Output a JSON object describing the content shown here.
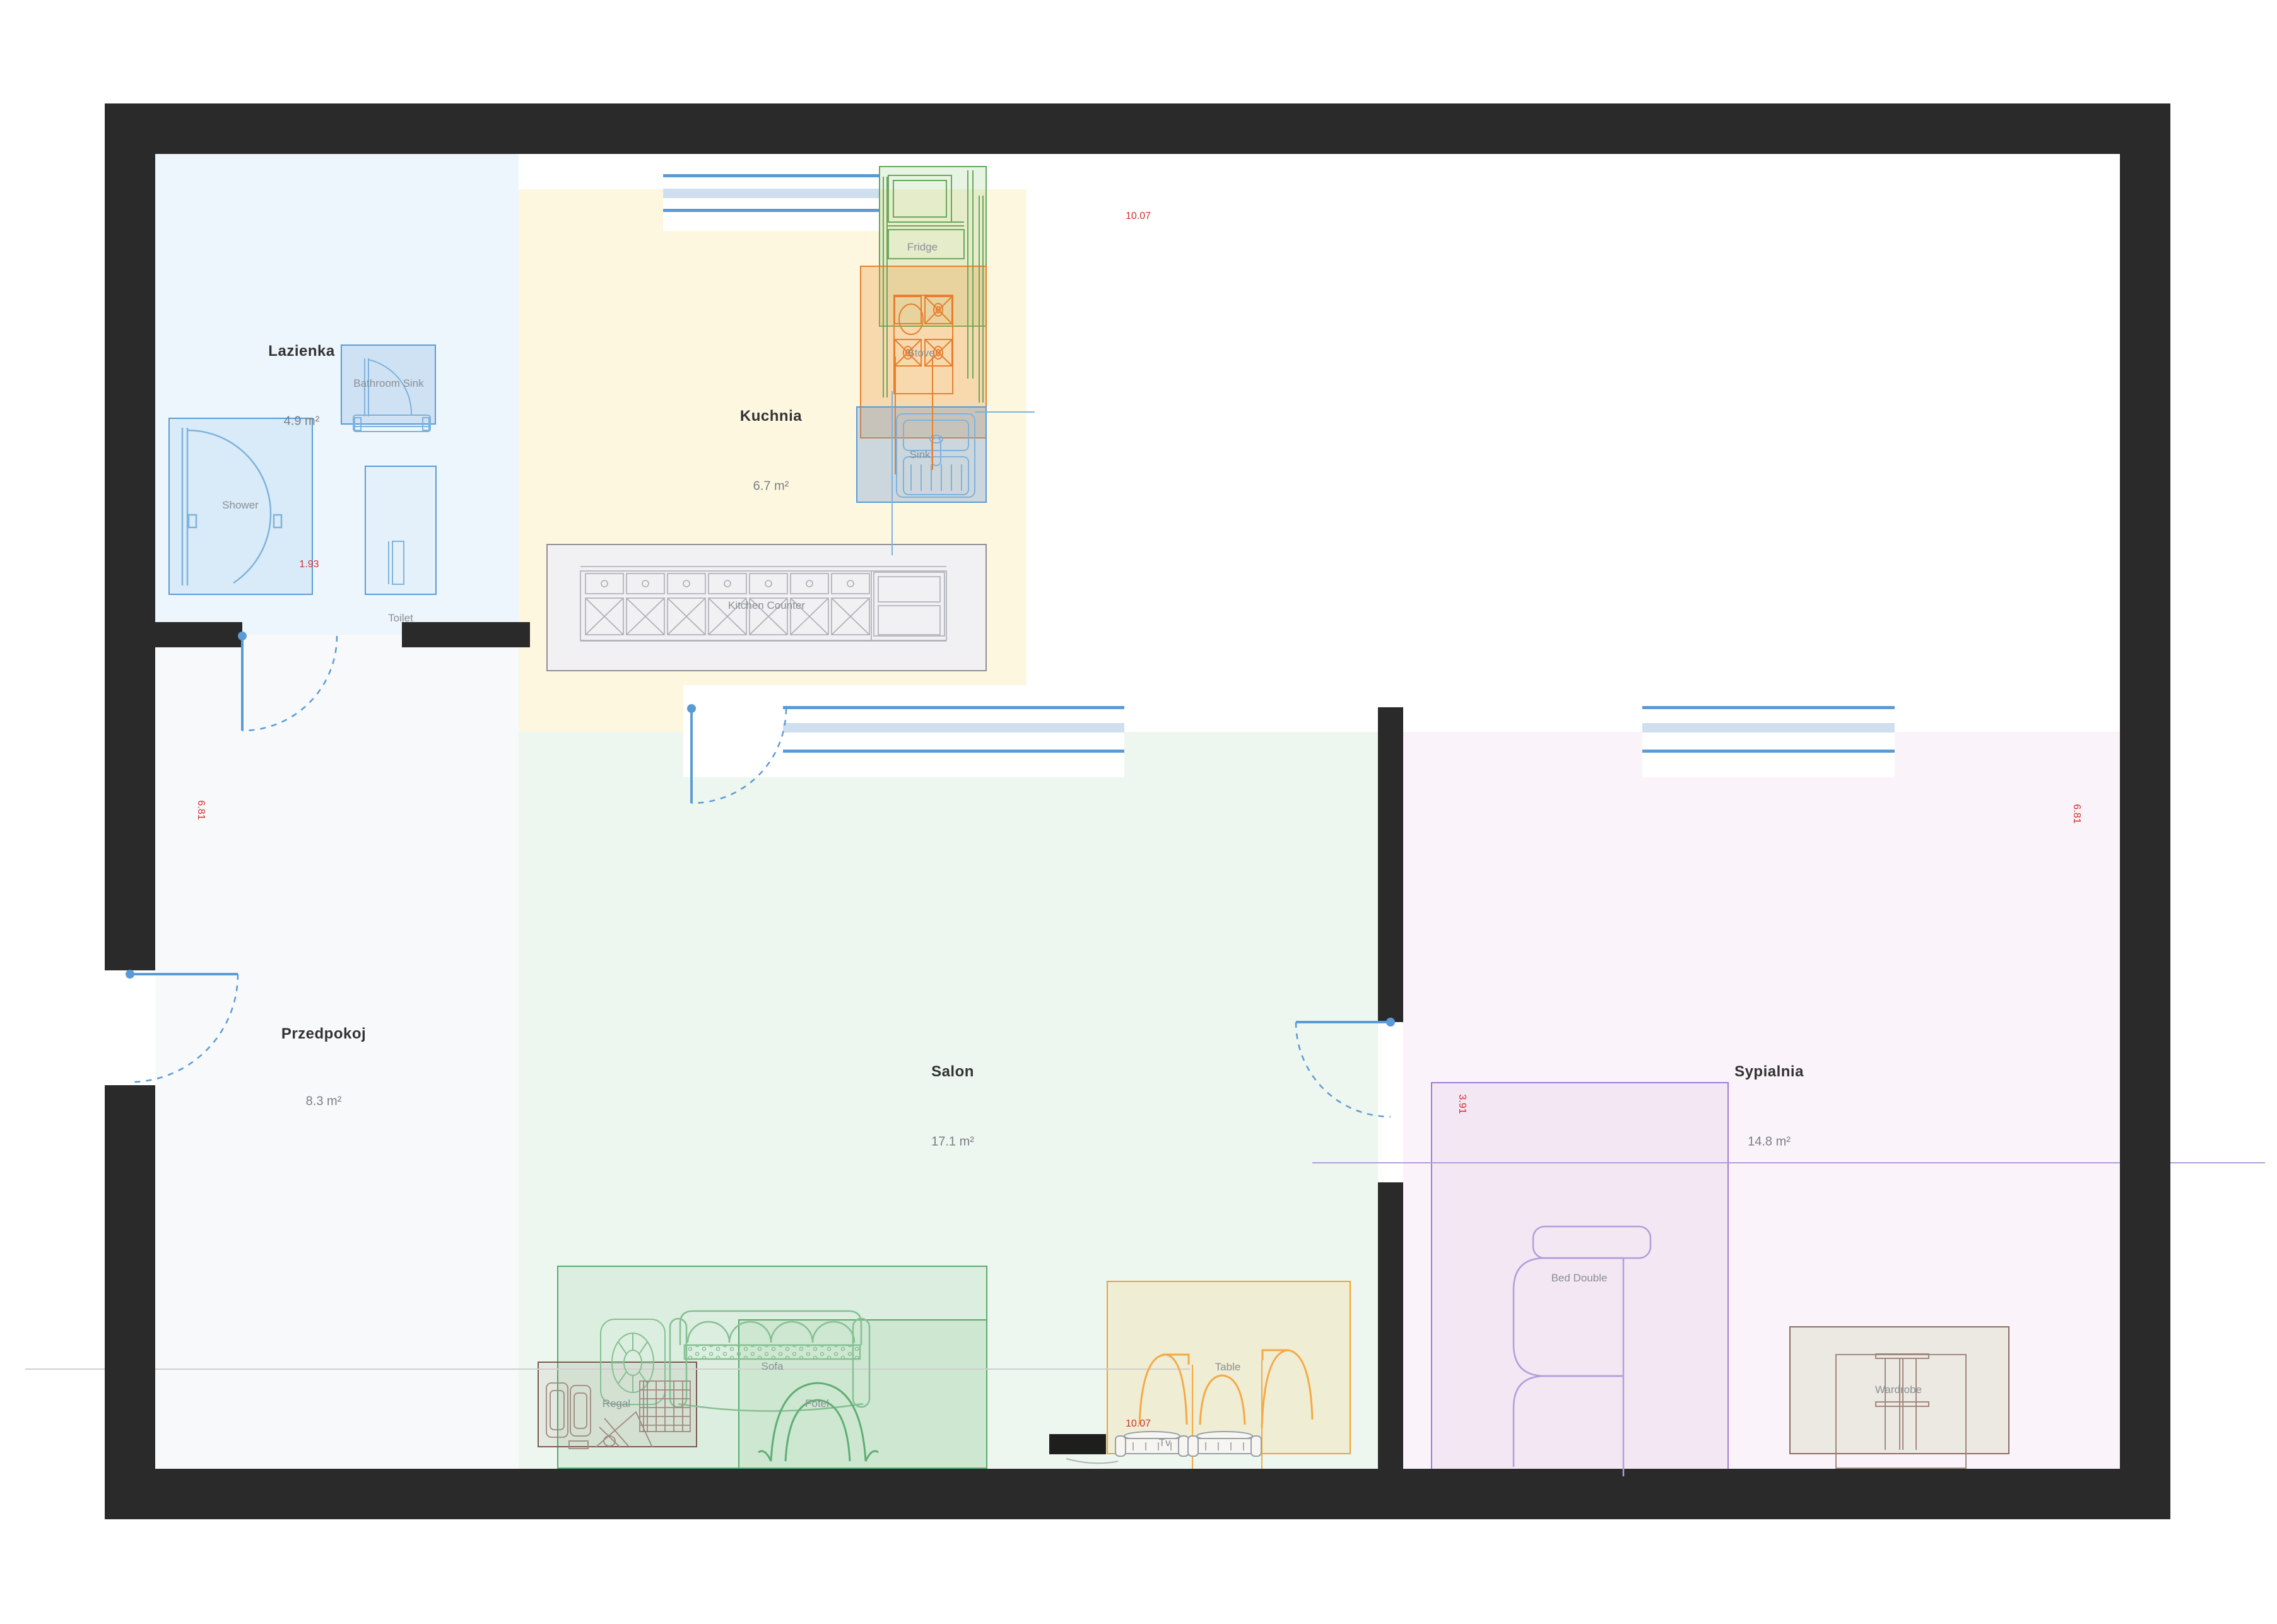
{
  "title": "Apartment floor plan",
  "rooms": {
    "lazienka": {
      "name": "Lazienka",
      "area": "4.9 m²"
    },
    "kuchnia": {
      "name": "Kuchnia",
      "area": "6.7 m²"
    },
    "przedpokoj": {
      "name": "Przedpokoj",
      "area": "8.3 m²"
    },
    "salon": {
      "name": "Salon",
      "area": "17.1 m²"
    },
    "sypialnia": {
      "name": "Sypialnia",
      "area": "14.8 m²"
    }
  },
  "furniture": {
    "shower": "Shower",
    "bathroom_sink": "Bathroom Sink",
    "toilet": "Toilet",
    "fridge": "Fridge",
    "stove": "Stove",
    "sink": "Sink",
    "kitchen_counter": "Kitchen Counter",
    "sofa": "Sofa",
    "fotel": "Fotel",
    "regal": "Regal",
    "table": "Table",
    "tv": "Tv",
    "bed": "Bed Double",
    "wardrobe": "Wardrobe"
  },
  "dimensions": {
    "width_top": "10.07",
    "width_bottom": "10.07",
    "height_left": "6.81",
    "height_right": "6.81",
    "shower_width": "1.93",
    "bed_zone_width": "3.91"
  },
  "colors": {
    "wall": "#2a2a2a",
    "bathroom_fill": "#edf6fc",
    "kitchen_fill": "#fdf7e0",
    "hallway_fill": "#f7f9fb",
    "salon_fill": "#edf6ef",
    "bedroom_fill": "#faf3f9",
    "blue": "#5b9bd5",
    "green": "#5aa86d",
    "orange": "#e87f2e",
    "amber": "#f0a232",
    "purple": "#9d7bd8",
    "brown": "#7a5a50",
    "red": "#d12f2f"
  }
}
